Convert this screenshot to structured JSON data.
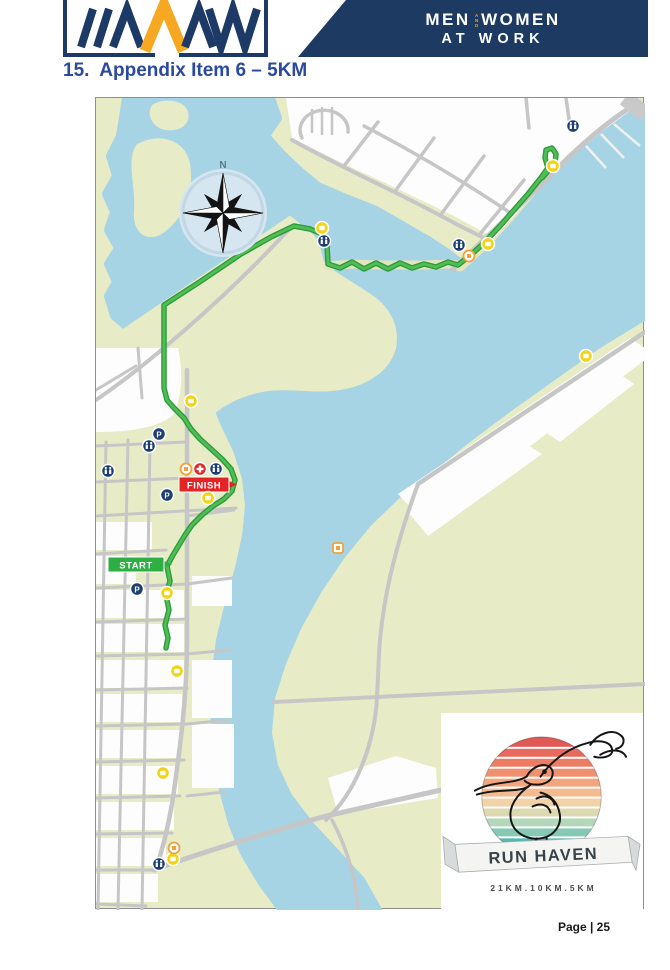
{
  "header": {
    "banner": {
      "line1_left": "MEN",
      "line1_mid": "AND",
      "line1_right": "WOMEN",
      "line2": "AT WORK"
    },
    "colors": {
      "navy": "#1d3a63",
      "gold": "#f5a81c"
    }
  },
  "heading": {
    "text": "15.  Appendix Item 6 – 5KM"
  },
  "map": {
    "compass_n": "N",
    "start_label": "START",
    "finish_label": "FINISH",
    "parking_glyph": "P",
    "marker_types": [
      {
        "name": "parking",
        "color": "#1c3e72"
      },
      {
        "name": "toilets",
        "color": "#1c3e72"
      },
      {
        "name": "first-aid",
        "color": "#e02629"
      },
      {
        "name": "point-of-interest",
        "color": "#f2d413"
      },
      {
        "name": "amenity",
        "color": "#f0a23a"
      }
    ],
    "colors": {
      "water": "#a7d4e5",
      "land": "#e8ecc6",
      "route": "#3fb14b",
      "road": "#c6c6c6",
      "start": "#2fae44",
      "finish": "#e32426"
    }
  },
  "run_haven": {
    "title": "RUN HAVEN",
    "distances": "21KM.10KM.5KM"
  },
  "footer": {
    "page_label": "Page | 25"
  }
}
